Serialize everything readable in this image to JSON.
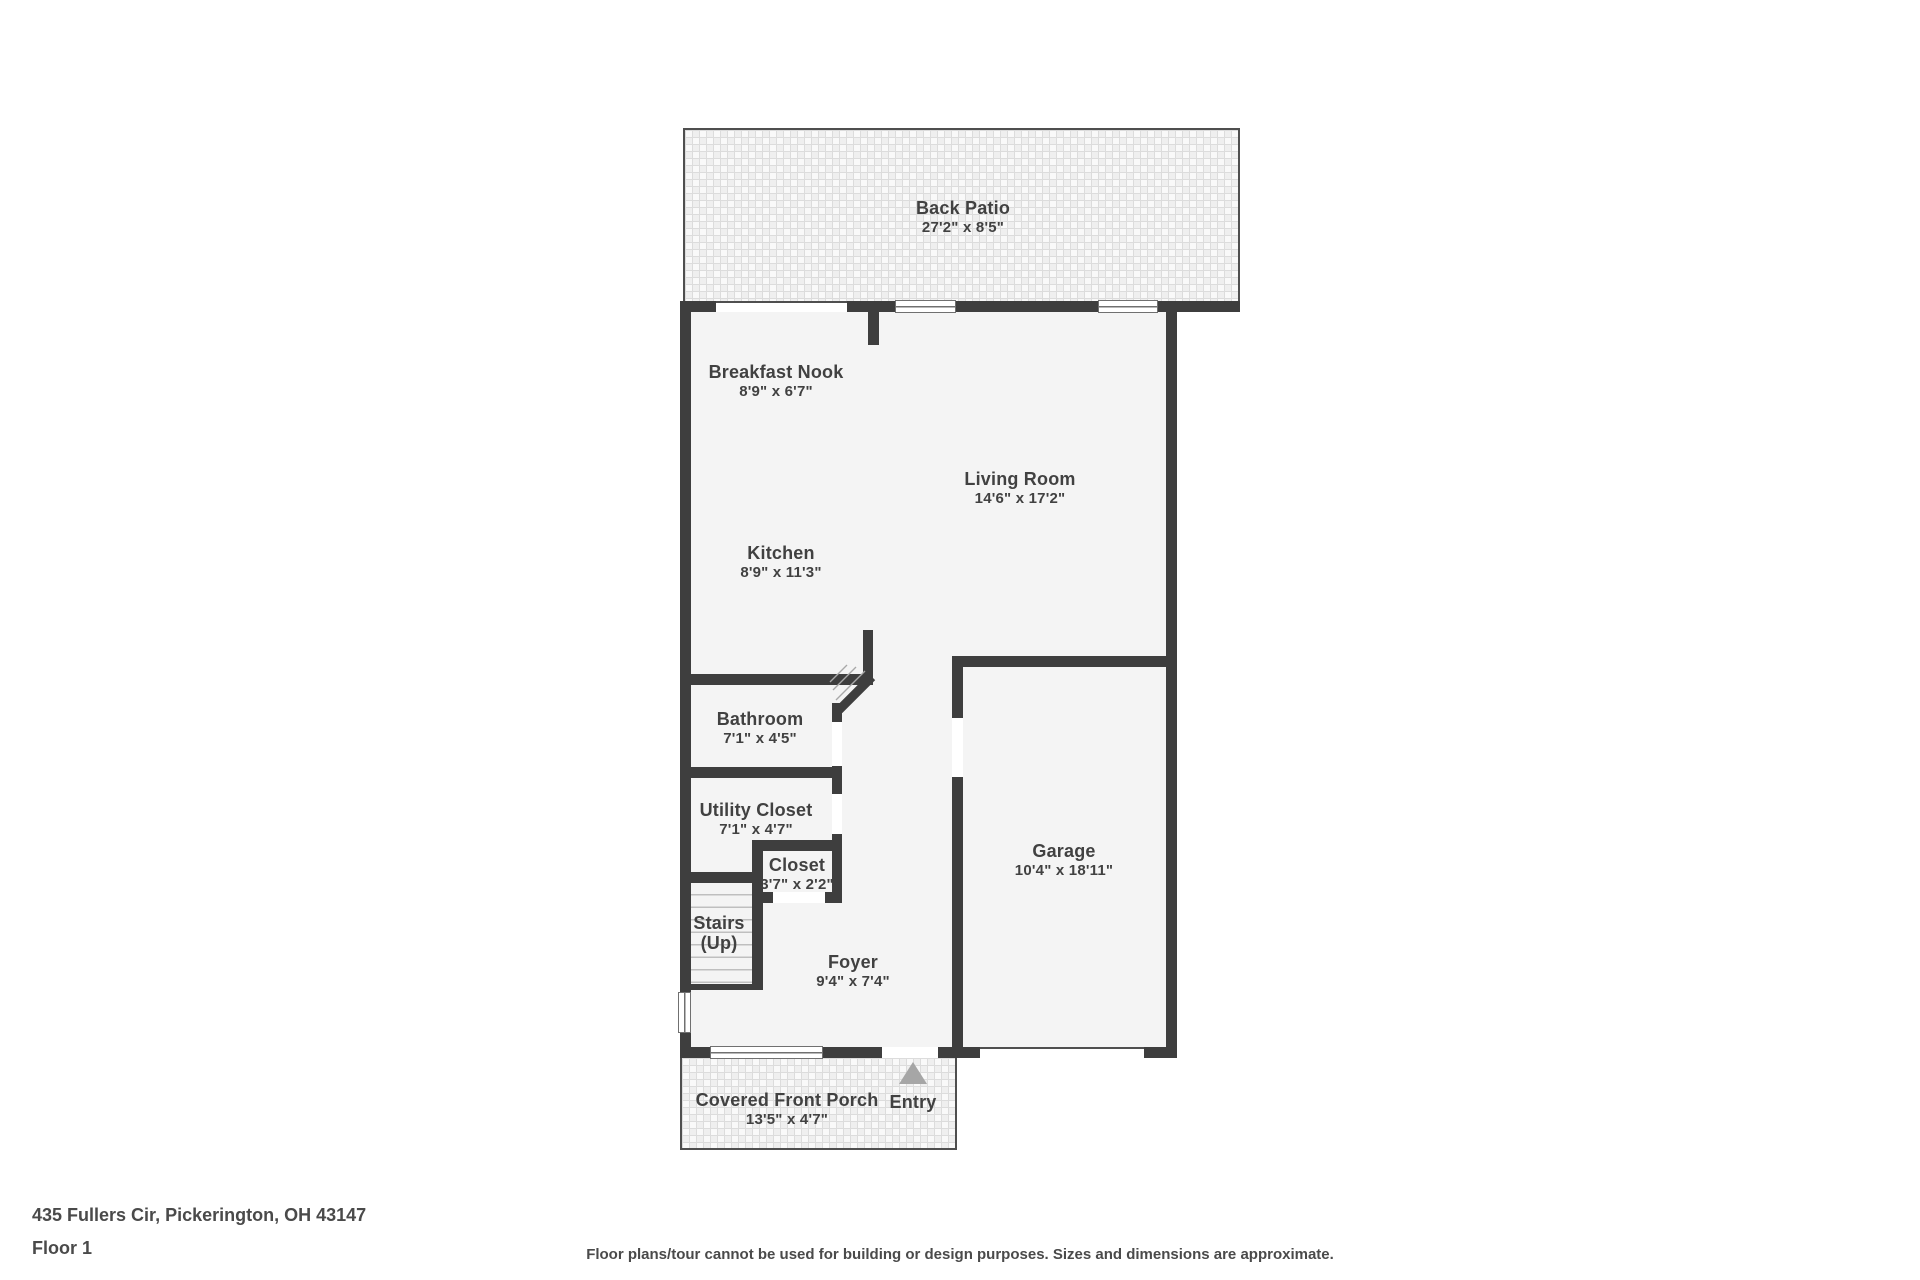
{
  "colors": {
    "wall": "#3e3e3e",
    "floor": "#f4f4f4",
    "text": "#414141",
    "entry_arrow": "#a6a6a6",
    "thin_outline": "#4f4f4f"
  },
  "floorplan": {
    "rooms": [
      {
        "id": "back-patio",
        "name": "Back Patio",
        "dims": "27'2\" x 8'5\""
      },
      {
        "id": "breakfast-nook",
        "name": "Breakfast Nook",
        "dims": "8'9\" x 6'7\""
      },
      {
        "id": "living-room",
        "name": "Living Room",
        "dims": "14'6\" x 17'2\""
      },
      {
        "id": "kitchen",
        "name": "Kitchen",
        "dims": "8'9\" x 11'3\""
      },
      {
        "id": "bathroom",
        "name": "Bathroom",
        "dims": "7'1\" x 4'5\""
      },
      {
        "id": "utility-closet",
        "name": "Utility Closet",
        "dims": "7'1\" x 4'7\""
      },
      {
        "id": "closet",
        "name": "Closet",
        "dims": "3'7\" x 2'2\""
      },
      {
        "id": "stairs",
        "name": "Stairs",
        "dims": "(Up)"
      },
      {
        "id": "foyer",
        "name": "Foyer",
        "dims": "9'4\" x 7'4\""
      },
      {
        "id": "garage",
        "name": "Garage",
        "dims": "10'4\" x 18'11\""
      },
      {
        "id": "covered-front-porch",
        "name": "Covered Front Porch",
        "dims": "13'5\" x 4'7\""
      }
    ],
    "entry_label": "Entry"
  },
  "footer": {
    "address": "435 Fullers Cir, Pickerington, OH 43147",
    "floor": "Floor 1",
    "disclaimer": "Floor plans/tour cannot be used for building or design purposes. Sizes and dimensions are approximate."
  }
}
